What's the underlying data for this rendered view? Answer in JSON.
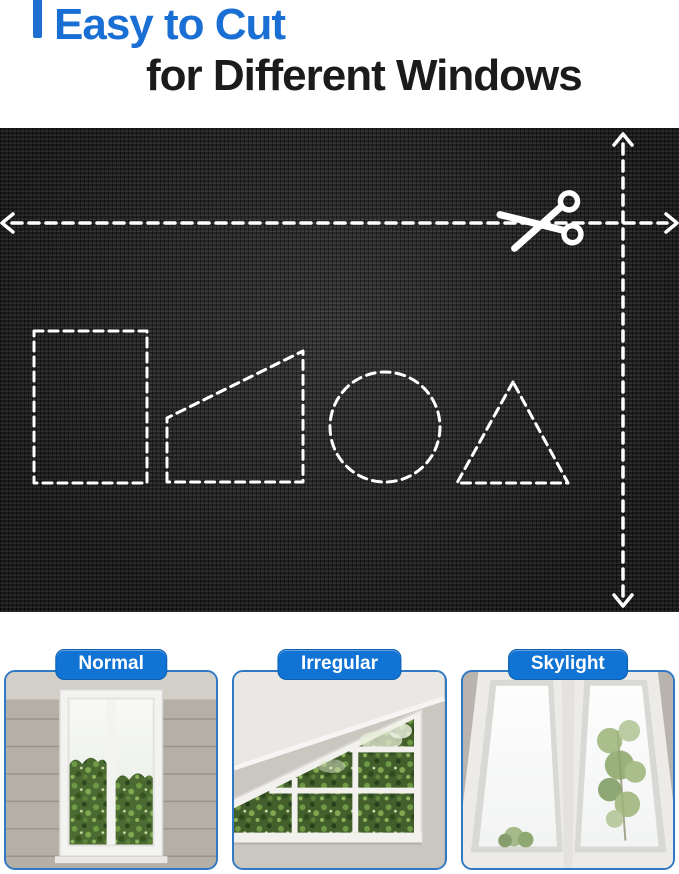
{
  "header": {
    "title_line1": "Easy to Cut",
    "title_line2": "for Different Windows"
  },
  "fabric_panel": {
    "scissors_icon": "scissors-icon",
    "cut_guides": [
      "horizontal-cut-line",
      "vertical-cut-line"
    ],
    "cut_shapes": [
      "rectangle",
      "trapezoid",
      "circle",
      "triangle"
    ]
  },
  "window_cards": [
    {
      "label": "Normal"
    },
    {
      "label": "Irregular"
    },
    {
      "label": "Skylight"
    }
  ],
  "colors": {
    "title_blue": "#1a6fd4",
    "badge_blue": "#1173d3",
    "card_border_blue": "#3079c5",
    "fabric_dark": "#262626",
    "cut_line_white": "#ffffff"
  }
}
